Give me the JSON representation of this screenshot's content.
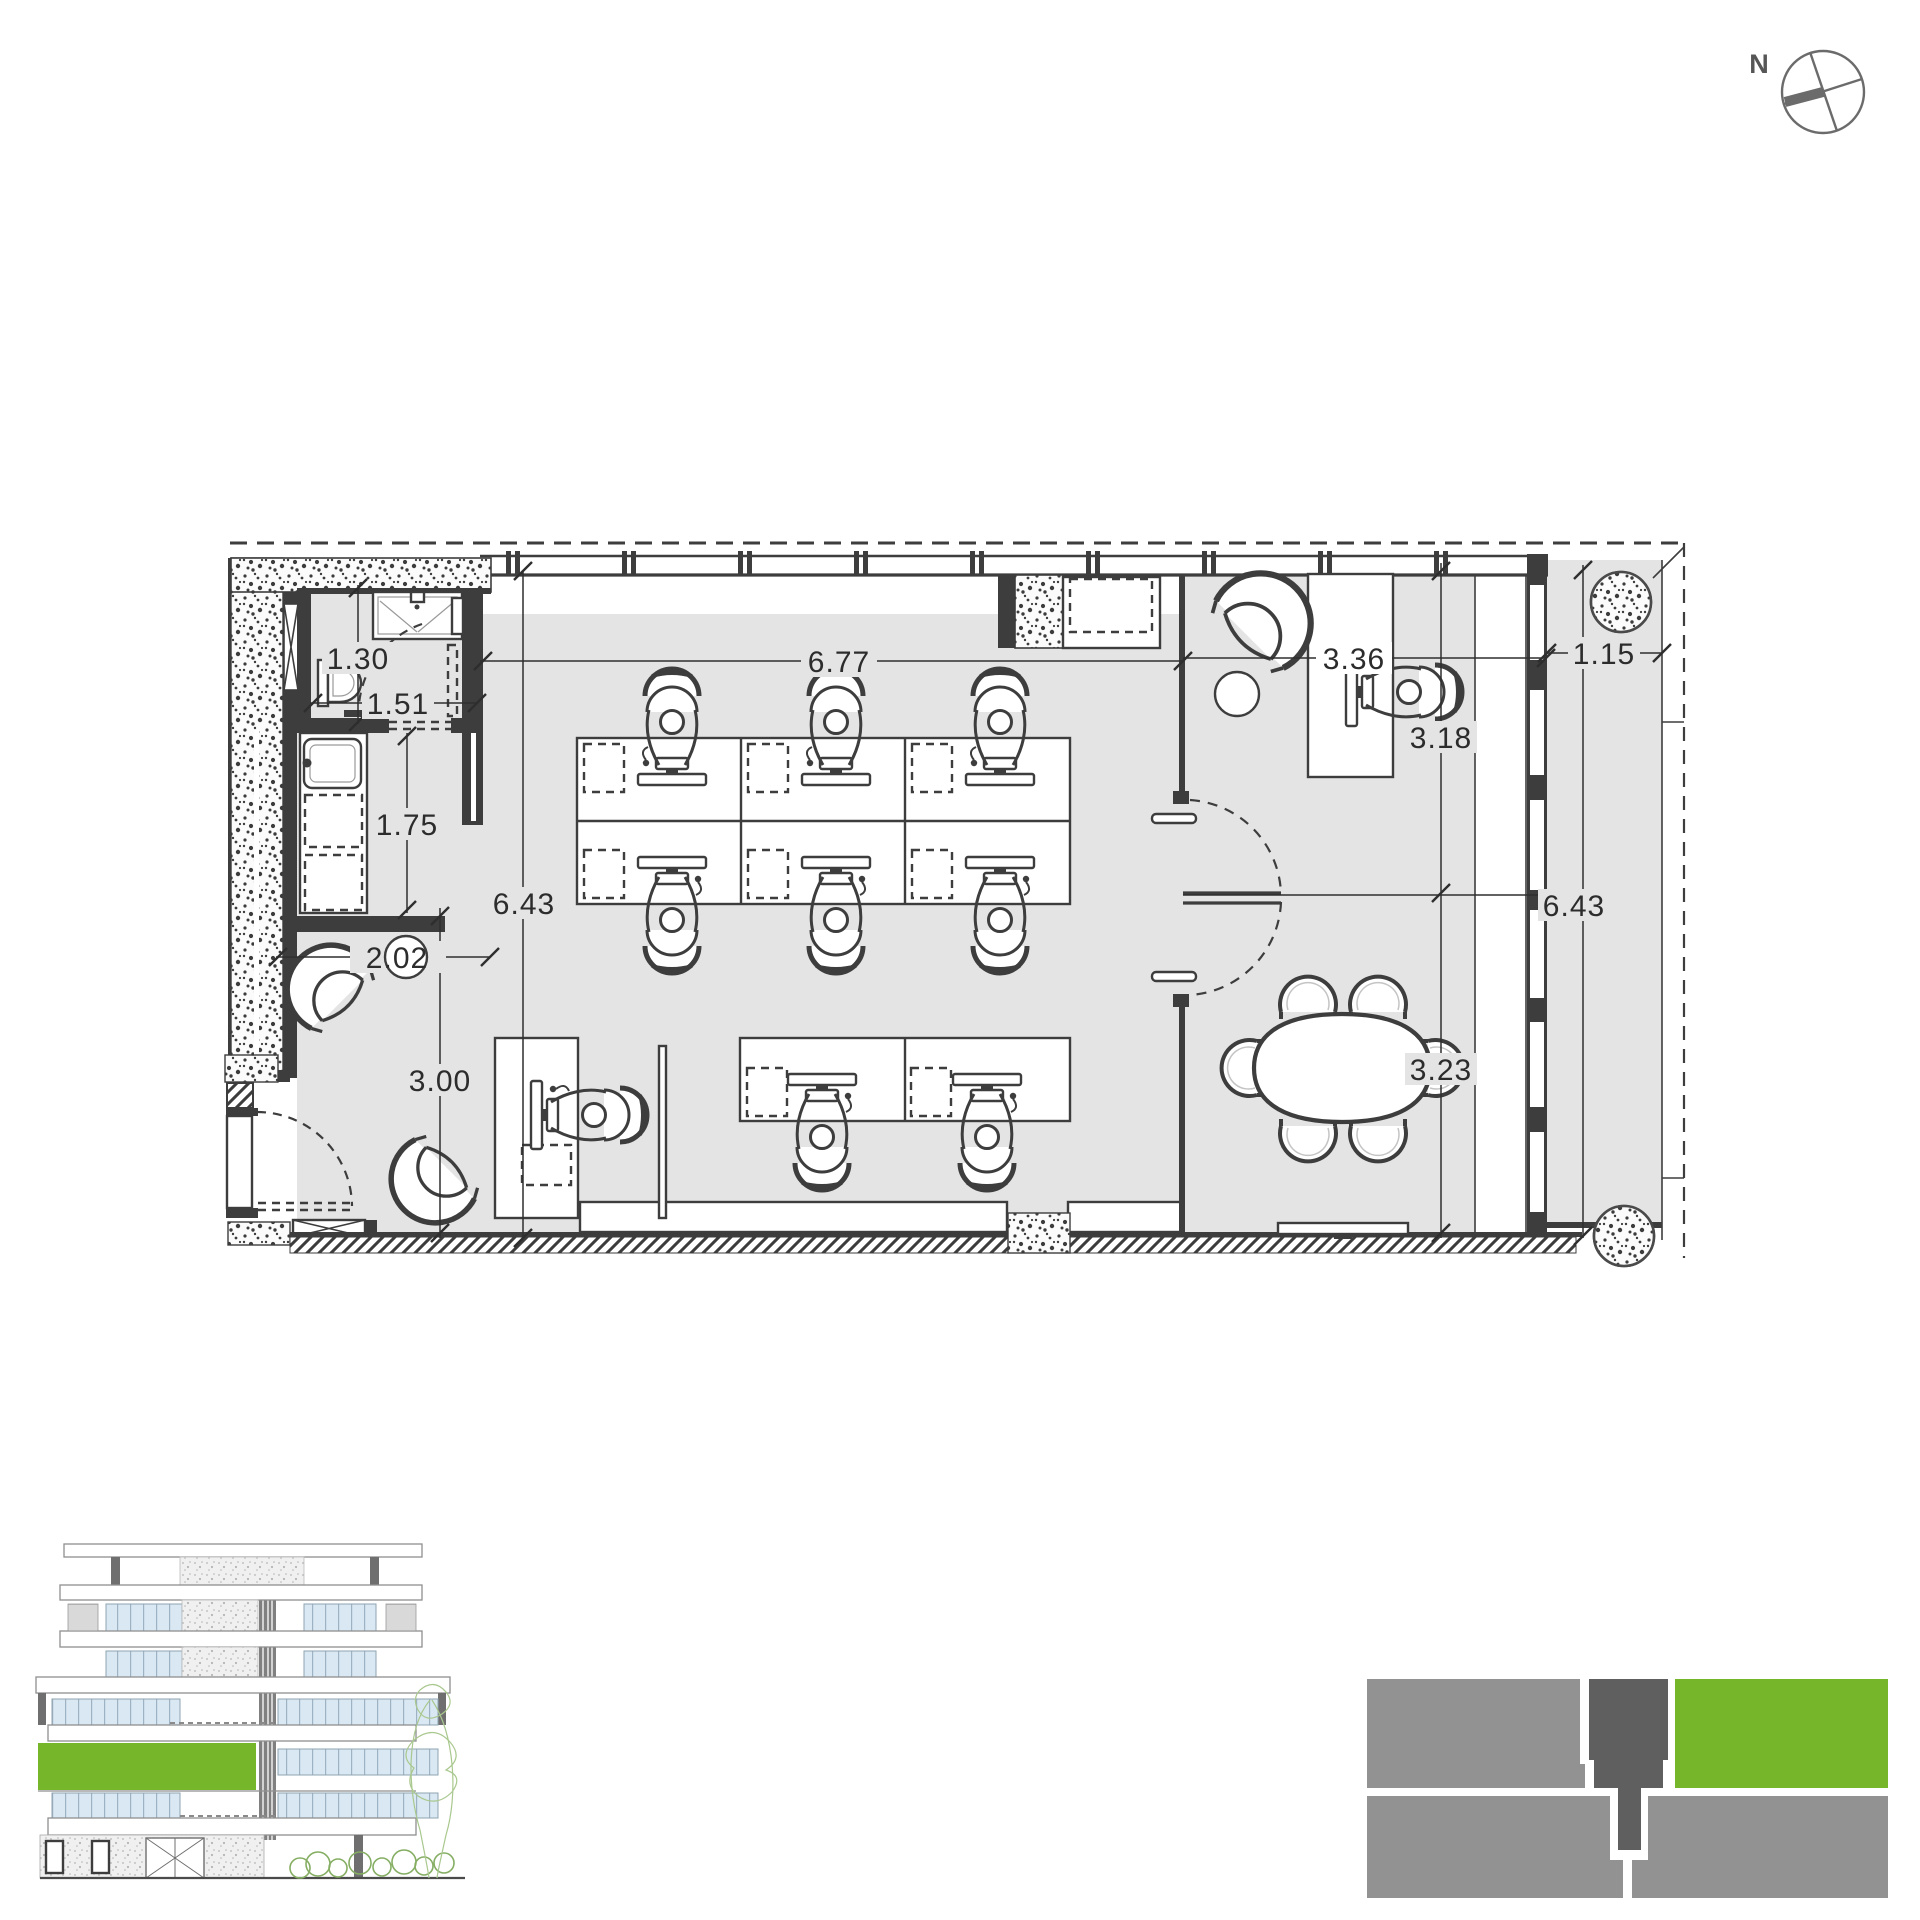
{
  "sheet": {
    "title": "office floor plan sheet"
  },
  "compass": {
    "label": "N"
  },
  "plan": {
    "dims": {
      "wc_width": "1.30",
      "wc_door": "1.51",
      "kitchen_depth": "1.75",
      "left_depth": "6.43",
      "lounge_width": "2.02",
      "lounge_depth": "3.00",
      "office_width": "6.77",
      "cabin_width": "3.36",
      "cabin_depth": "3.18",
      "terrace_width": "1.15",
      "right_depth": "6.43",
      "meeting_depth": "3.23"
    }
  },
  "colors": {
    "wall": "#3d3d3d",
    "floor": "#e4e4e4",
    "accent_green": "#75b62b",
    "site_gray": "#929292",
    "site_dark": "#5f5f5f"
  }
}
